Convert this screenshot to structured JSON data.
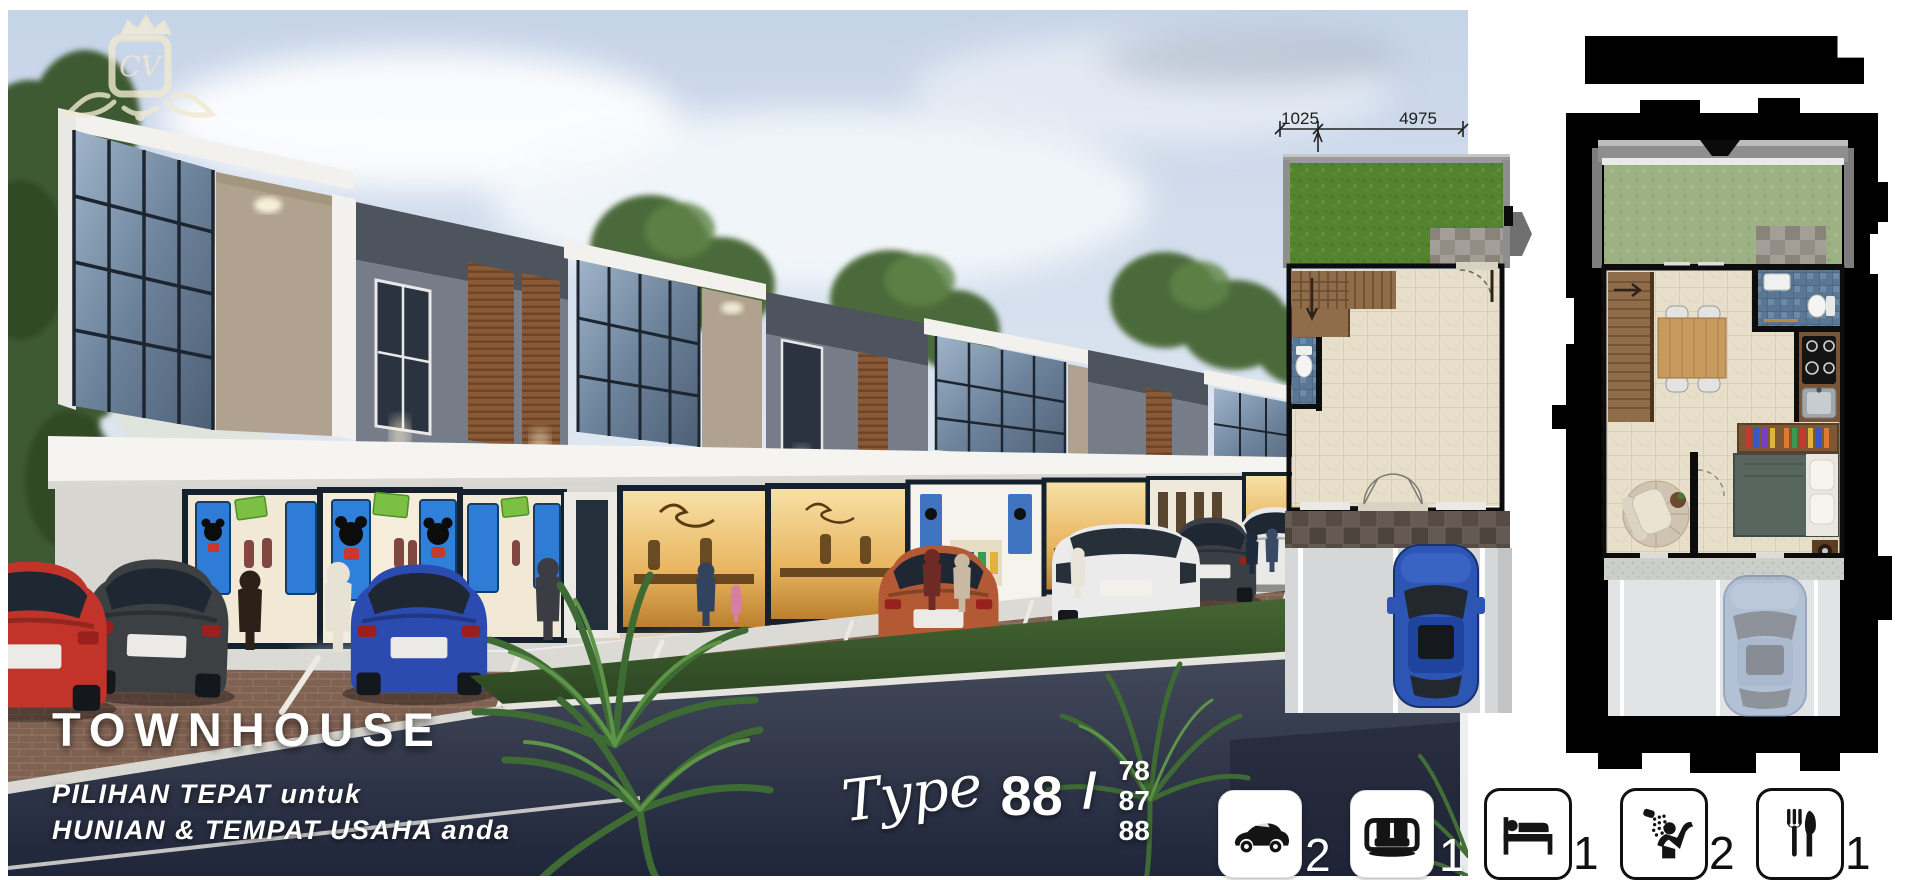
{
  "logo": {
    "monogram": "CV"
  },
  "headline": {
    "title": "TOWNHOUSE",
    "subtitle_line1": "PILIHAN TEPAT untuk",
    "subtitle_line2": "HUNIAN & TEMPAT USAHA anda"
  },
  "type_label": {
    "word": "Type",
    "main": "88",
    "separator": "/",
    "variants": [
      "78",
      "87",
      "88"
    ]
  },
  "floorplans": {
    "dimension_left": "1025",
    "dimension_right": "4975"
  },
  "amenities": [
    {
      "icon": "car-icon",
      "count": "2"
    },
    {
      "icon": "sofa-icon",
      "count": "1"
    },
    {
      "icon": "bed-icon",
      "count": "1"
    },
    {
      "icon": "shower-icon",
      "count": "2"
    },
    {
      "icon": "cutlery-icon",
      "count": "1"
    }
  ],
  "colors": {
    "plan_garden_green": "#55842f",
    "plan2_garden_green": "#9cb285",
    "road_navy": "#232838",
    "sky_blue": "#cfdcec",
    "bar_black": "#000000"
  }
}
